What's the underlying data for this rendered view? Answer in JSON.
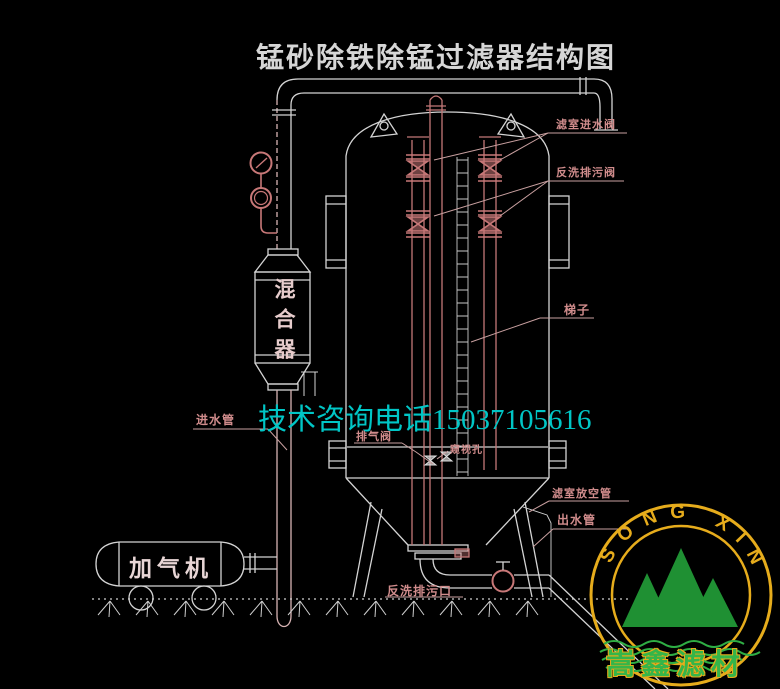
{
  "title": "锰砂除铁除锰过滤器结构图",
  "watermark": {
    "phone": "技术咨询电话15037105616",
    "color": "#00c6c6"
  },
  "labels": {
    "filter_inlet_valve": "滤室进水阀",
    "backwash_drain_valve": "反洗排污阀",
    "ladder": "梯子",
    "exhaust_valve": "排气阀",
    "sight_hole": "窥视孔",
    "inlet_pipe": "进水管",
    "mixer": "混合器",
    "aerator": "加气机",
    "chamber_vent_pipe": "滤室放空管",
    "outlet_pipe": "出水管",
    "backwash_drain_outlet": "反洗排污口"
  },
  "logo": {
    "arc_text": "SONG XIN",
    "company": "嵩鑫滤材",
    "ring_color": "#e6ac1c",
    "mountain_color": "#1f9033",
    "wave_color": "#2fae44",
    "company_color": "#35b549"
  },
  "colors": {
    "background": "#000000",
    "line_white": "#d4d4d4",
    "line_pink": "#c47878",
    "label_pink": "#d08c8c",
    "title_gray": "#d6d6d6"
  }
}
